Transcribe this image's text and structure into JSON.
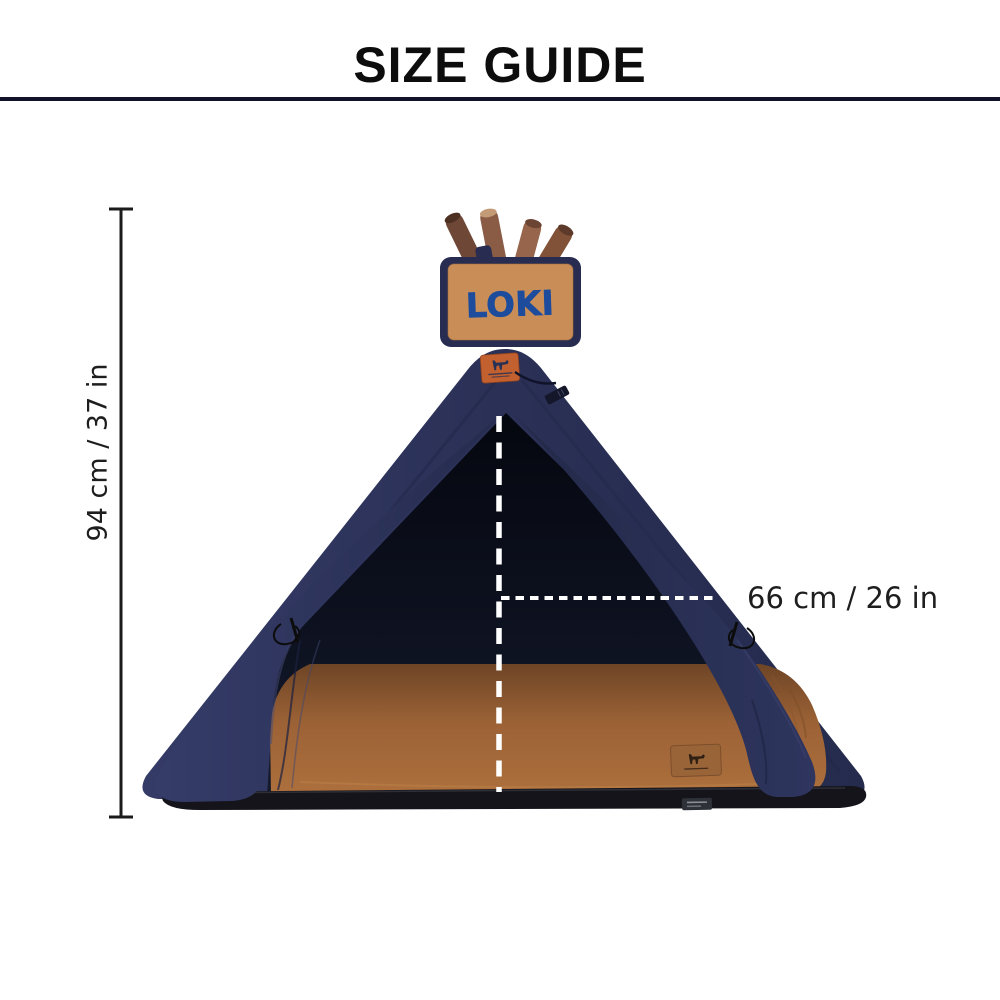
{
  "header": {
    "title": "SIZE GUIDE"
  },
  "illustration": {
    "name_sign": "LOKI",
    "icons": {
      "apex_patch": "dog-logo-patch-icon",
      "mat_patch": "dog-logo-patch-icon",
      "hang_tag": "hang-tag-icon",
      "poles": "wood-poles-icon",
      "ties": "tie-cord-icon"
    },
    "colors": {
      "tent_navy": "#2b3157",
      "tent_navy_dark": "#1f2442",
      "interior_dark": "#0a0d19",
      "mat_caramel": "#9c6236",
      "sign_fill": "#c98e58",
      "sign_border": "#272c50",
      "sign_text_blue": "#1d4c9c",
      "patch_orange": "#c2602f",
      "wood_brown": "#7d5340",
      "dash_white": "#ffffff",
      "dimension_black": "#1b1b1b",
      "divider": "#12122a"
    }
  },
  "dimensions": {
    "height_label": "94 cm / 37 in",
    "width_label": "66 cm / 26 in"
  }
}
